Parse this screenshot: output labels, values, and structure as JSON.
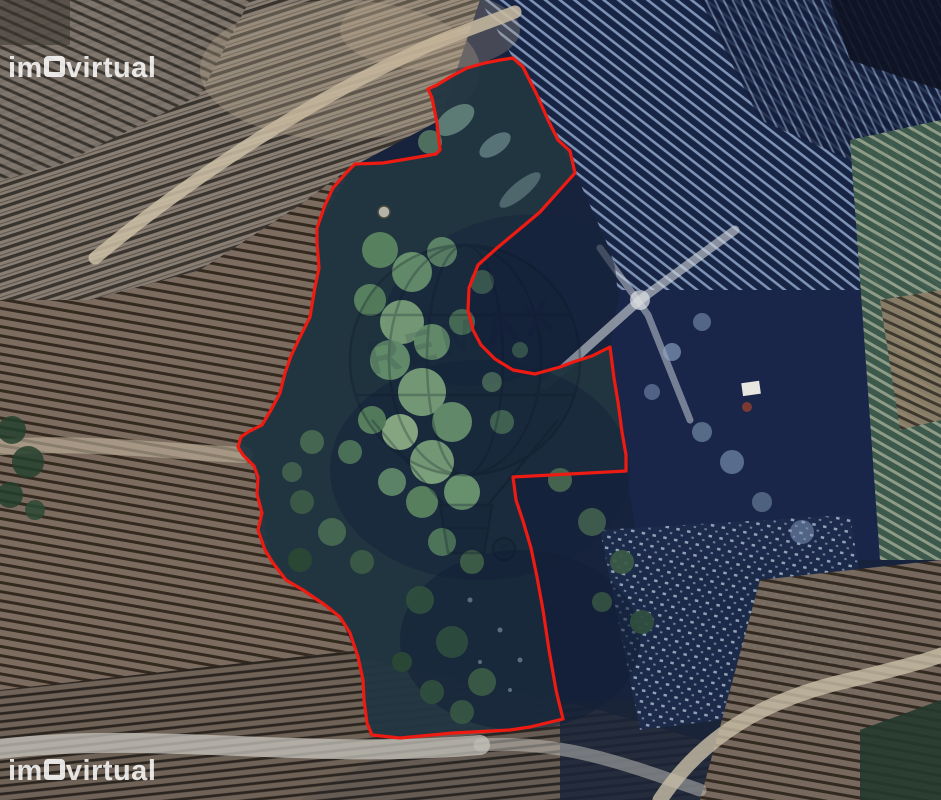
{
  "photo": {
    "kind": "satellite-aerial-photo",
    "subject": "terraced vineyard hillsides with a forested land plot outlined in red",
    "boundary_color": "#ee1b12"
  },
  "watermarks": {
    "portal": {
      "text": "imovirtual",
      "text_before_o": "im",
      "text_after_o": "virtual",
      "color": "#ffffff",
      "positions": [
        "top-left",
        "bottom-left"
      ]
    },
    "agency": {
      "shape": "hot-air-balloon",
      "text": "REMAX",
      "copyright_symbol": "©"
    }
  },
  "boundary": {
    "svg_path": "M513,58 L523,67 L537,95 L548,120 L558,140 L570,151 L575,173 L540,212 L527,223 L497,248 L478,265 L469,288 L468,310 L473,330 L481,345 L495,359 L513,370 L535,374 L560,367 L573,362 L592,356 L610,347 L614,378 L618,402 L622,432 L626,455 L626,471 L570,474 L513,477 L516,500 L523,521 L531,548 L537,577 L543,610 L549,650 L556,690 L563,719 L530,727 L510,730 L453,733 L400,738 L372,735 L367,723 L364,700 L363,680 L358,657 L350,633 L340,617 L325,605 L303,590 L286,580 L273,563 L265,550 L258,530 L262,513 L257,494 L258,477 L254,466 L243,455 L238,447 L241,437 L248,432 L262,425 L271,410 L280,393 L285,373 L291,356 L299,339 L310,317 L315,287 L319,268 L317,243 L317,228 L325,205 L333,188 L347,172 L355,164 L383,163 L413,158 L436,154 L440,150 L437,123 L432,98 L428,89 L437,85 L450,77 L467,68 L485,63 L500,60 Z"
  }
}
